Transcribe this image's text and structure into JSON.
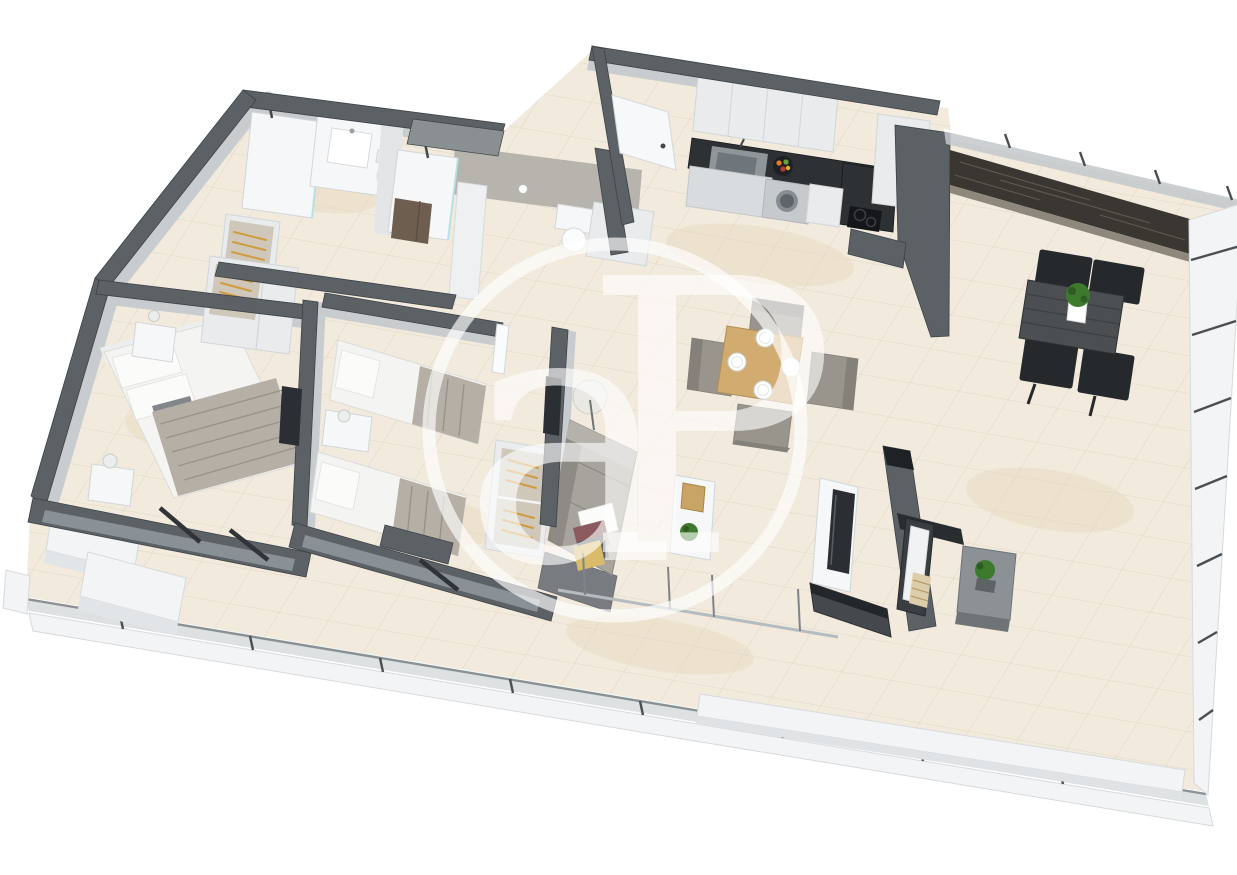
{
  "watermark": {
    "letters": "aP"
  },
  "colors": {
    "wall_top": "#5c6165",
    "wall_edge": "#3d4246",
    "wall_face": "#c9cccf",
    "wall_face_dark": "#a2a7aa",
    "wall_recess": "#8a8f92",
    "concrete": "#b7b4ae",
    "floor": "#f1eadd",
    "grout": "#e0d7c4",
    "floor_warm": "#e9dabd",
    "counter": "#2d3134",
    "cabinet": "#e9ebed",
    "cabinet_line": "#d2d6d8",
    "fixture_white": "#f6f7f8",
    "steel": "#8f969a",
    "marble": "#3a3631",
    "marble_streak": "#7a7264",
    "glass": "#c3c8cb",
    "railing_white": "#f2f4f5",
    "railing_line": "#d7dadc",
    "post": "#4a4f53",
    "wood": "#d2ab71",
    "wood_edge": "#b08e55",
    "outdoor_table": "#4b4f52",
    "chair_gray": "#99958d",
    "chair_dark": "#84807a",
    "chair_black": "#26292b",
    "sofa": "#a7a39d",
    "sofa_dark": "#8e8a84",
    "bed_white": "#f4f4f2",
    "pillow_white": "#fbfbfa",
    "duvet": "#b5afa6",
    "duvet_line": "#948e84",
    "headboard": "#eceeef",
    "pillow_maroon": "#8a5a5e",
    "pillow_dark": "#5d6165",
    "pillow_yellow": "#d9bc6a",
    "tv": "#2b2e32",
    "hanger": "#d09a3e",
    "closet_inner": "#cfc8ba",
    "plant": "#3e7a2e",
    "plant_dark": "#2e5c22",
    "watermark": "#ffffff"
  },
  "scene": {
    "type": "3d-floor-plan-render",
    "rooms": [
      "bathroom",
      "shower-room",
      "master-bedroom",
      "second-bedroom",
      "hallway",
      "entrance",
      "kitchen",
      "living-dining-room",
      "terrace",
      "balcony"
    ],
    "objects": [
      "double-bed",
      "single-beds",
      "nightstands",
      "wardrobe-hangers",
      "closet-hangers",
      "sofa",
      "cushions",
      "coffee-table",
      "floor-lamp",
      "dining-table-plates",
      "dining-chairs",
      "wall-tv",
      "kitchen-counter",
      "kitchen-sink",
      "washing-machine",
      "cooktop",
      "fruit-bowl",
      "outdoor-dining-table",
      "outdoor-chairs",
      "lounge-chair",
      "side-table",
      "plants",
      "toilets",
      "showers",
      "vanity-sink",
      "entry-door",
      "glass-railing",
      "marble-parapet",
      "bench"
    ]
  }
}
